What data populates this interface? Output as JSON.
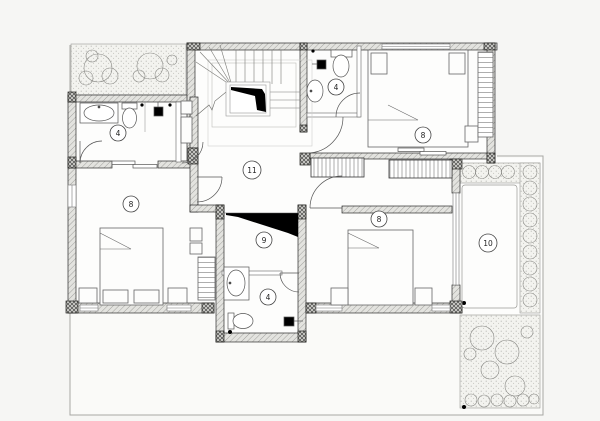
{
  "plan": {
    "drawing_type": "architectural floor plan",
    "rooms": [
      {
        "id": "bathroom-top-left",
        "number": "4"
      },
      {
        "id": "bathroom-top-right",
        "number": "4"
      },
      {
        "id": "bedroom-top-right",
        "number": "8"
      },
      {
        "id": "bedroom-left",
        "number": "8"
      },
      {
        "id": "hall",
        "number": "11"
      },
      {
        "id": "stair-void",
        "number": "9"
      },
      {
        "id": "bedroom-bottom-right",
        "number": "8"
      },
      {
        "id": "bathroom-bottom",
        "number": "4"
      },
      {
        "id": "terrace",
        "number": "10"
      }
    ],
    "colors": {
      "paper": "#f6f6f4",
      "floor": "#fdfdfc",
      "wall_line": "#2b2b2b",
      "wall_hatch": "#8f8f8c",
      "site_line": "#a8a8a4",
      "solid_black": "#000000",
      "vegetation_line": "#8a8a86"
    }
  }
}
